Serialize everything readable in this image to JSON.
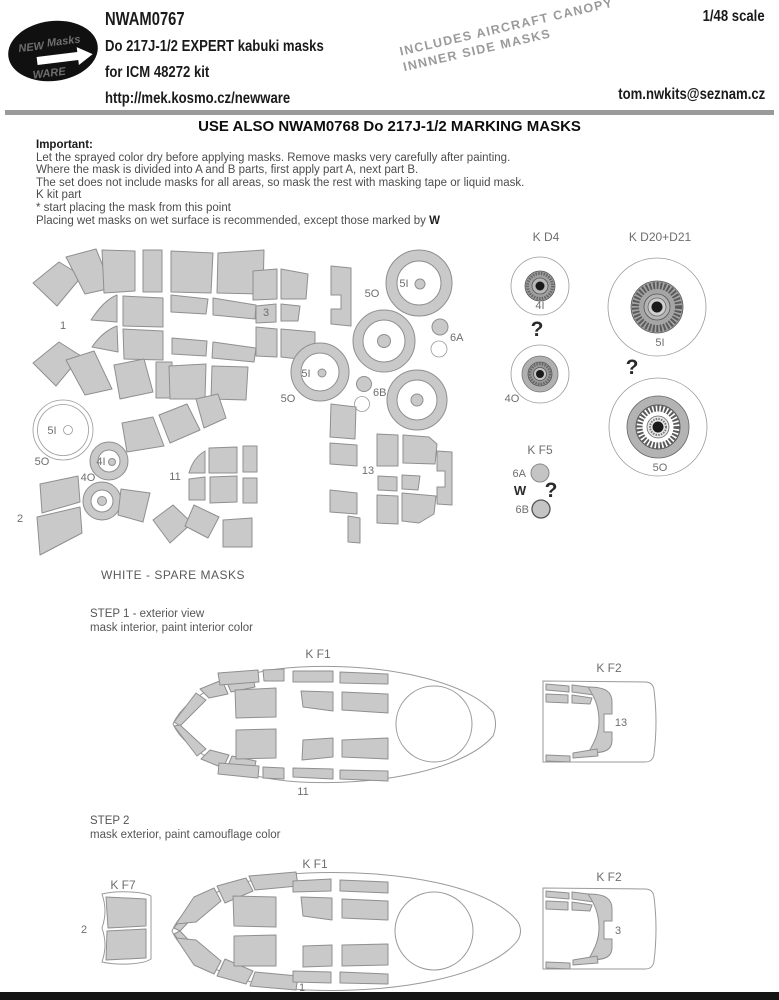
{
  "colors": {
    "mask_fill": "#c9c9c9",
    "mask_stroke": "#8f8f8f",
    "outline": "#9a9a9a",
    "label": "#6e6e6e",
    "top_bar": "#9a9a9a",
    "bottom_bar": "#141414"
  },
  "header": {
    "logo_line1": "NEW",
    "logo_line2": "Masks",
    "logo_line3": "WARE",
    "product_code": "NWAM0767",
    "title_line1": "Do 217J-1/2 EXPERT kabuki masks",
    "title_line2": "for ICM 48272 kit",
    "url": "http://mek.kosmo.cz/newware",
    "scale": "1/48 scale",
    "email": "tom.nwkits@seznam.cz",
    "note_line1": "INCLUDES AIRCRAFT CANOPY",
    "note_line2": "INNNER SIDE  MASKS"
  },
  "notice": "USE ALSO NWAM0768 Do 217J-1/2 MARKING MASKS",
  "instructions": {
    "heading": "Important:",
    "line1": "Let the sprayed color dry before applying masks. Remove masks very carefully after painting.",
    "line2": "Where the mask is divided into A and B parts, first apply part A, next part B.",
    "line3": "The set does not include masks for all areas, so mask the rest with masking tape or liquid mask.",
    "line4": "K kit part",
    "line5": "*  start placing the mask from this point",
    "line6_prefix": "Placing wet masks on wet surface is recommended, except those marked by ",
    "line6_symbol": "W"
  },
  "sheet_labels": {
    "n1": "1",
    "n2": "2",
    "n3": "3",
    "n11": "11",
    "n13": "13",
    "i4": "4I",
    "o4": "4O",
    "i5": "5I",
    "o5": "5O",
    "a6": "6A",
    "b6": "6B"
  },
  "parts": {
    "kd4": "K D4",
    "kd20": "K D20+D21",
    "kf5": "K F5",
    "kf1": "K F1",
    "kf2": "K F2",
    "kf7": "K F7",
    "question": "?",
    "wet": "W"
  },
  "spare_note": "WHITE - SPARE MASKS",
  "step1": {
    "title": "STEP 1 - exterior view",
    "subtitle": "mask interior, paint interior color"
  },
  "step2": {
    "title": "STEP 2",
    "subtitle": "mask exterior, paint camouflage color"
  }
}
